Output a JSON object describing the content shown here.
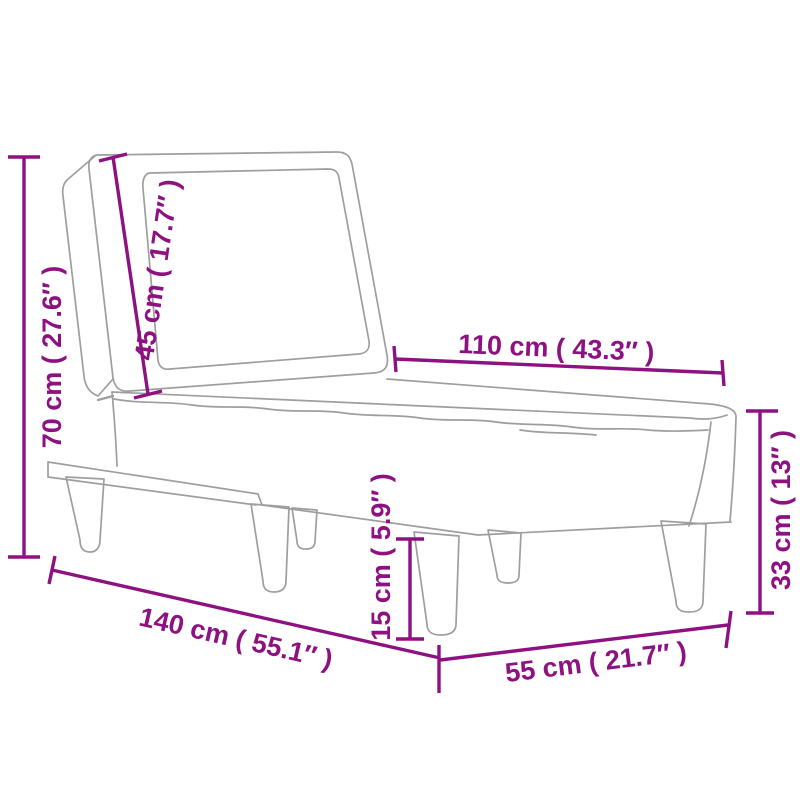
{
  "figure": {
    "name": "chaise-lounge-dimension-diagram"
  },
  "colors": {
    "dimension": "#8E1182",
    "sketch_line": "#9E9E9E",
    "background": "#FFFFFF"
  },
  "dimensions": {
    "total_height": {
      "label": "70 cm ( 27.6″ )",
      "cm": 70,
      "inches": 27.6
    },
    "backrest_height": {
      "label": "45 cm ( 17.7″ )",
      "cm": 45,
      "inches": 17.7
    },
    "seat_length": {
      "label": "110 cm ( 43.3″ )",
      "cm": 110,
      "inches": 43.3
    },
    "seat_height": {
      "label": "33 cm ( 13″ )",
      "cm": 33,
      "inches": 13
    },
    "leg_height": {
      "label": "15 cm ( 5.9″ )",
      "cm": 15,
      "inches": 5.9
    },
    "total_length": {
      "label": "140 cm ( 55.1″ )",
      "cm": 140,
      "inches": 55.1
    },
    "seat_width": {
      "label": "55 cm ( 21.7″ )",
      "cm": 55,
      "inches": 21.7
    }
  }
}
